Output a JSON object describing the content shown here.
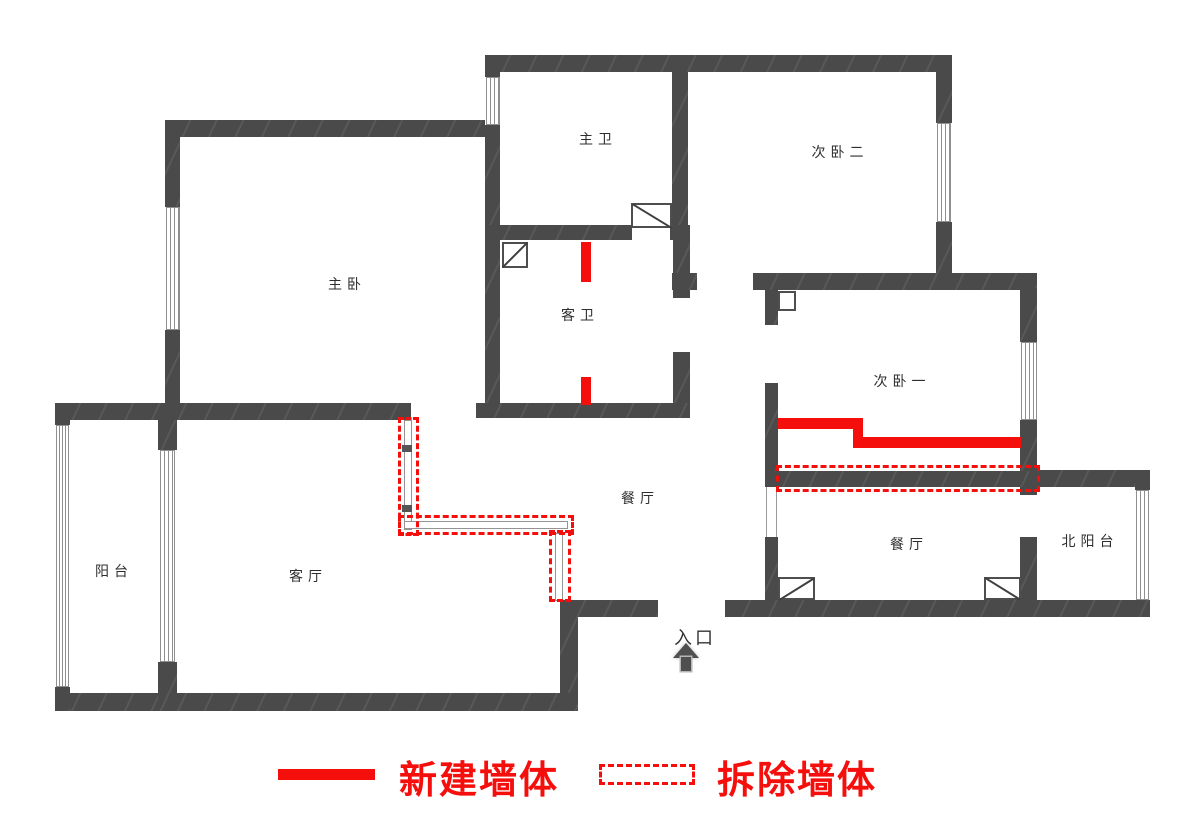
{
  "colors": {
    "wall": "#4a4a4a",
    "accent_red": "#f40f0c",
    "window_line": "#8f8f8f",
    "label_text": "#2e2e2e"
  },
  "rooms": [
    {
      "id": "master-bath",
      "label": "主卫"
    },
    {
      "id": "bedroom-2",
      "label": "次卧二"
    },
    {
      "id": "master-bedroom",
      "label": "主卧"
    },
    {
      "id": "guest-bath",
      "label": "客卫"
    },
    {
      "id": "bedroom-1",
      "label": "次卧一"
    },
    {
      "id": "balcony",
      "label": "阳台"
    },
    {
      "id": "living-room",
      "label": "客厅"
    },
    {
      "id": "dining-room",
      "label": "餐厅"
    },
    {
      "id": "dining-room-2",
      "label": "餐厅"
    },
    {
      "id": "north-balcony",
      "label": "北阳台"
    }
  ],
  "entrance": {
    "label": "入口"
  },
  "legend": {
    "items": [
      {
        "style": "solid",
        "label": "新建墙体"
      },
      {
        "style": "dashed",
        "label": "拆除墙体"
      }
    ]
  }
}
